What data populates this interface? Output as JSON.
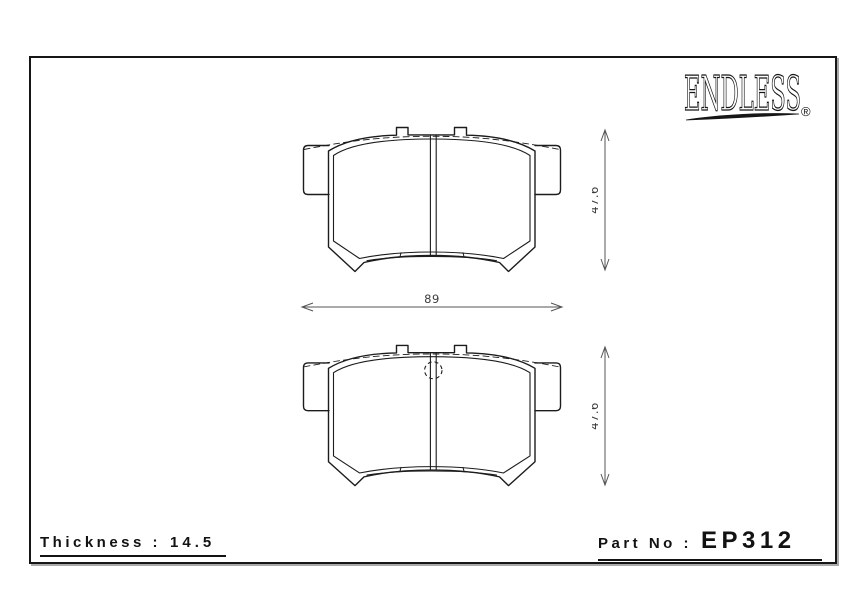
{
  "logo": {
    "brand": "ENDLESS",
    "registered_mark": "®"
  },
  "dimensions": {
    "top_pad_height_mm": "47.6",
    "pad_width_mm": "89",
    "bottom_pad_height_mm": "47.6"
  },
  "footer": {
    "thickness_label": "Thickness :",
    "thickness_value": "14.5",
    "part_no_label": "Part No :",
    "part_no_value": "EP312"
  },
  "colors": {
    "line": "#1c1c1c",
    "dimension_line": "#555555",
    "text": "#121212"
  }
}
